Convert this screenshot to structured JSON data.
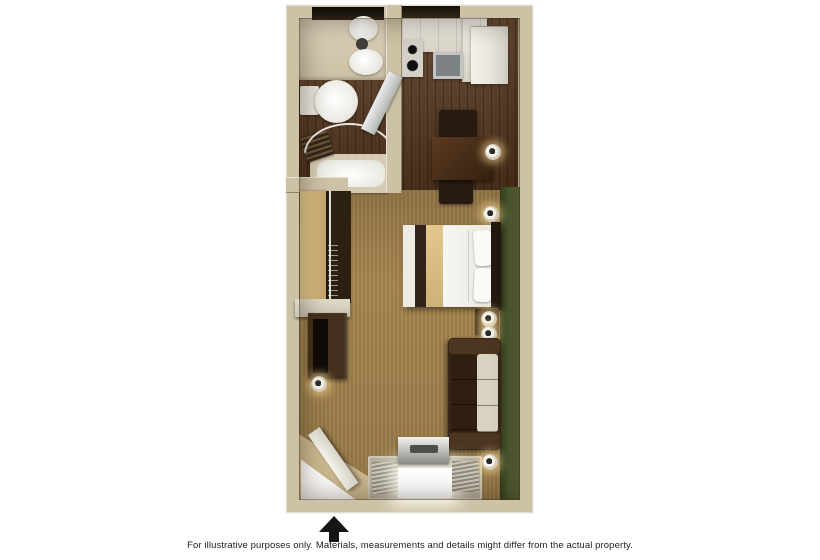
{
  "page": {
    "background": "#ffffff"
  },
  "floor_plan": {
    "type": "studio-hotel-room-floorplan",
    "rooms": [
      "bathroom",
      "kitchen",
      "closet",
      "living-sleeping-area",
      "entry"
    ],
    "furniture": [
      "vanity-sink",
      "mirror",
      "toilet",
      "bathtub",
      "towel",
      "shower-rod",
      "kitchen-counter",
      "cooktop",
      "kitchen-sink",
      "refrigerator",
      "mirrored-door",
      "dining-table",
      "dining-chairs",
      "queen-bed",
      "pillows",
      "headboard",
      "nightstand",
      "wall-lamps",
      "sofa",
      "closet-sliding-door",
      "dresser",
      "television",
      "air-conditioner",
      "window-blinds",
      "entry-door"
    ],
    "colors": {
      "page_bg": "#ffffff",
      "wall": "#cdc2a6",
      "accent_wall": "#4e5c33",
      "wood_floor": "#57381f",
      "carpet": "#a5854f",
      "dark_wood_furniture": "#3a2817",
      "linens": "#f5f4f0",
      "closet_door": "#d9be86",
      "entry_marker": "#151515"
    },
    "entry_marker": {
      "shape": "arrow-up"
    }
  },
  "caption": {
    "text": "For illustrative purposes only.  Materials, measurements and details might differ from the actual property."
  }
}
